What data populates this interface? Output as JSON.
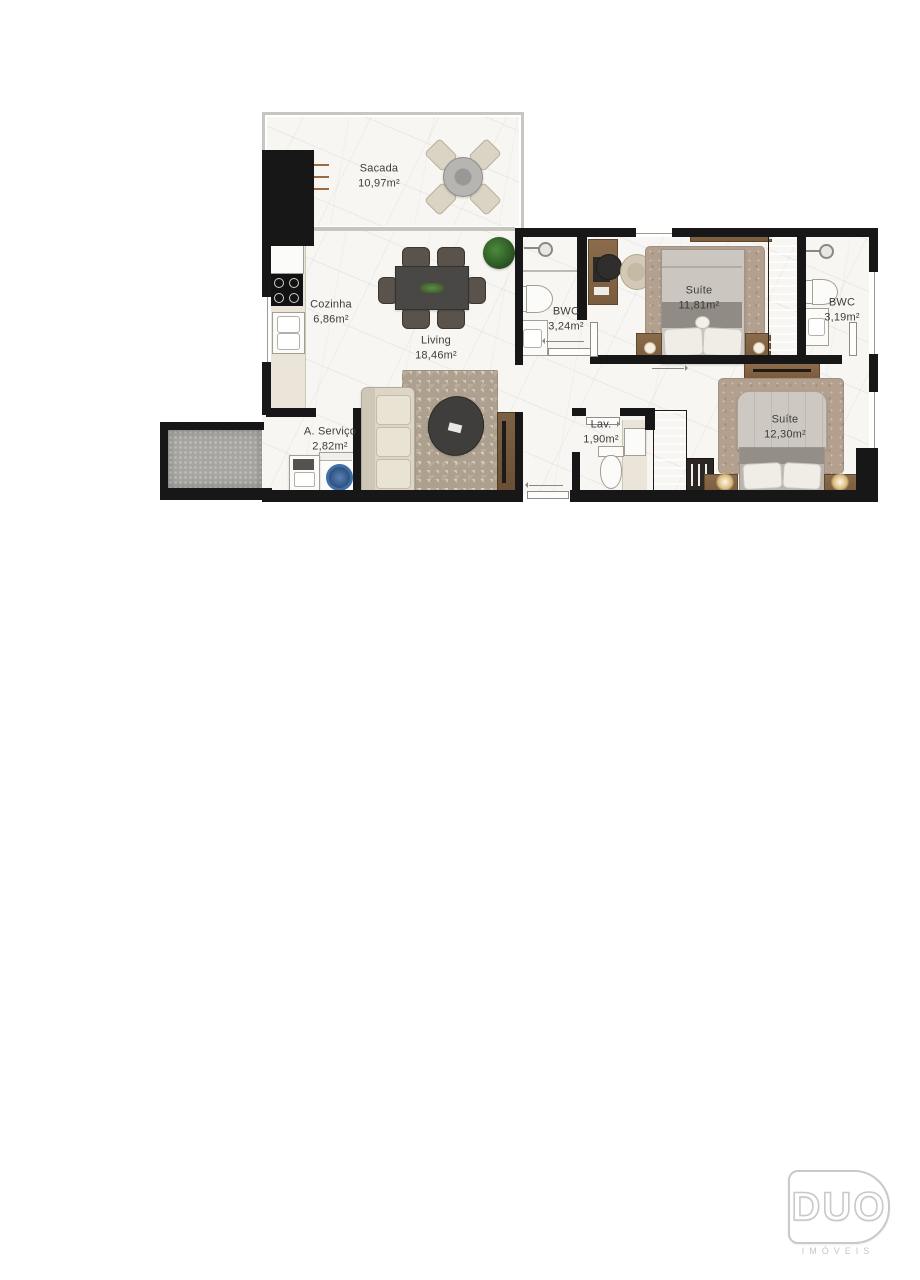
{
  "plan": {
    "rooms": [
      {
        "id": "sacada",
        "name": "Sacada",
        "area": "10,97m²"
      },
      {
        "id": "cozinha",
        "name": "Cozinha",
        "area": "6,86m²"
      },
      {
        "id": "living",
        "name": "Living",
        "area": "18,46m²"
      },
      {
        "id": "bwc_social",
        "name": "BWC",
        "area": "3,24m²"
      },
      {
        "id": "suite_1",
        "name": "Suíte",
        "area": "11,81m²"
      },
      {
        "id": "bwc_suite",
        "name": "BWC",
        "area": "3,19m²"
      },
      {
        "id": "area_servico",
        "name": "A. Serviço",
        "area": "2,82m²"
      },
      {
        "id": "lavabo",
        "name": "Lav.",
        "area": "1,90m²"
      },
      {
        "id": "suite_2",
        "name": "Suíte",
        "area": "12,30m²"
      }
    ],
    "colors": {
      "wall": "#171717",
      "floor": "#f7f6f3",
      "wood": "#8a6b4b",
      "label_text": "#3d3c3a"
    }
  },
  "logo": {
    "brand": "DUO",
    "tagline": "IMÓVEIS"
  }
}
